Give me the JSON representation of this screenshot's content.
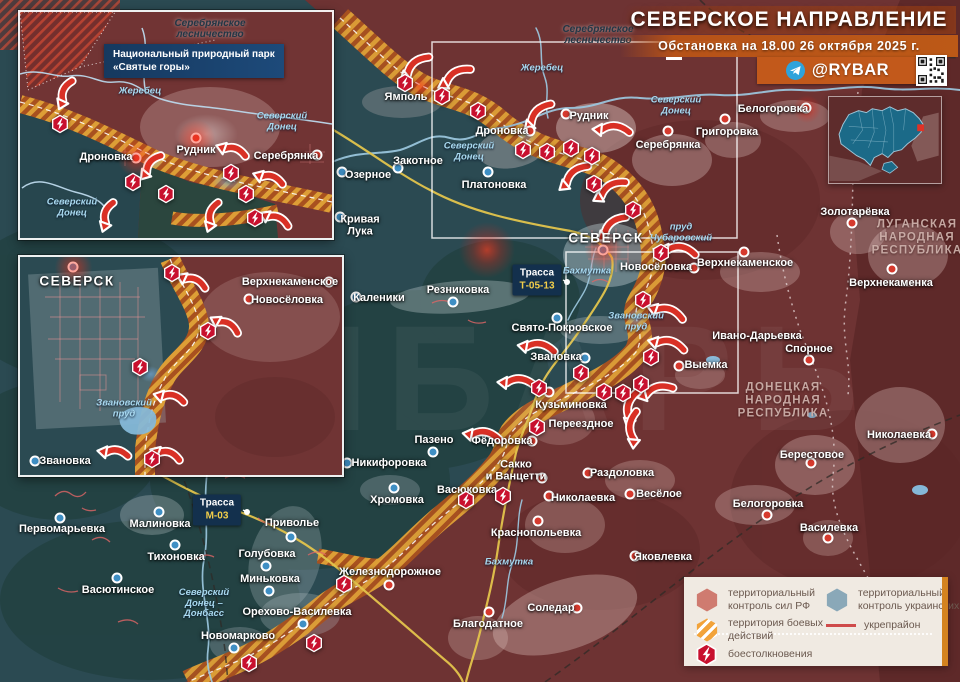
{
  "title": {
    "heading": "СЕВЕРСКОЕ НАПРАВЛЕНИЕ",
    "subtitle": "Обстановка на 18.00 26 октября 2025 г."
  },
  "branding": {
    "telegram_handle": "@RYBAR"
  },
  "colors": {
    "rf_territory": "#6e3333",
    "ua_territory": "#2b4a52",
    "combat_zone": "#dd9e36",
    "combat_stripe": "#a8511f",
    "arrow_red": "#d93025",
    "clash_red": "#c8102e",
    "accent_orange": "#c2591b",
    "legend_bg": "#f0eae2"
  },
  "legend": {
    "items": [
      {
        "id": "rf",
        "label": "территориальный контроль сил РФ"
      },
      {
        "id": "combat",
        "label": "территория боевых действий"
      },
      {
        "id": "clash",
        "label": "боестолкновения"
      },
      {
        "id": "ua",
        "label": "территориальный контроль украинских сил"
      },
      {
        "id": "fort",
        "label": "укрепрайон"
      }
    ]
  },
  "map": {
    "settlements": [
      {
        "n": "Ямполь",
        "x": 406,
        "y": 97,
        "s": "ru"
      },
      {
        "n": "Дроновка",
        "x": 502,
        "y": 131,
        "s": "ru",
        "dot": [
          530,
          131
        ]
      },
      {
        "n": "Рудник",
        "x": 589,
        "y": 116,
        "s": "ru",
        "dot": [
          566,
          114
        ]
      },
      {
        "n": "Серебрянка",
        "x": 668,
        "y": 145,
        "s": "ru",
        "dot": [
          668,
          131
        ]
      },
      {
        "n": "Григоровка",
        "x": 727,
        "y": 132,
        "s": "ru",
        "dot": [
          725,
          119
        ]
      },
      {
        "n": "Белогоровка",
        "x": 773,
        "y": 109,
        "s": "ru",
        "dot": [
          806,
          108
        ]
      },
      {
        "n": "Золотарёвка",
        "x": 855,
        "y": 212,
        "s": "ru",
        "dot": [
          852,
          223
        ]
      },
      {
        "n": "Верхнекаменка",
        "x": 891,
        "y": 283,
        "s": "ru",
        "dot": [
          892,
          269
        ]
      },
      {
        "n": "Озерное",
        "x": 368,
        "y": 175,
        "s": "ua",
        "dot": [
          342,
          172
        ]
      },
      {
        "n": "Закотное",
        "x": 418,
        "y": 161,
        "s": "ua",
        "dot": [
          398,
          168
        ]
      },
      {
        "n": "Платоновка",
        "x": 494,
        "y": 185,
        "s": "ua",
        "dot": [
          488,
          172
        ]
      },
      {
        "n": "Кривая\nЛука",
        "x": 360,
        "y": 226,
        "s": "ua",
        "dot": [
          340,
          217
        ]
      },
      {
        "n": "СЕВЕРСК",
        "x": 606,
        "y": 238,
        "s": "ua",
        "big": true,
        "dot": [
          603,
          250
        ],
        "glow": true
      },
      {
        "n": "Новосёловка",
        "x": 656,
        "y": 267,
        "s": "ru",
        "dot": [
          694,
          268
        ]
      },
      {
        "n": "Верхнекаменское",
        "x": 745,
        "y": 263,
        "s": "ru",
        "dot": [
          744,
          252
        ]
      },
      {
        "n": "Каленики",
        "x": 379,
        "y": 298,
        "s": "ua",
        "dot": [
          356,
          297
        ]
      },
      {
        "n": "Резниковка",
        "x": 458,
        "y": 290,
        "s": "ua",
        "dot": [
          453,
          302
        ]
      },
      {
        "n": "Свято-Покровское",
        "x": 562,
        "y": 328,
        "s": "ua",
        "dot": [
          557,
          318
        ]
      },
      {
        "n": "Звановка",
        "x": 556,
        "y": 357,
        "s": "ua",
        "dot": [
          585,
          358
        ]
      },
      {
        "n": "Ивано-Дарьевка",
        "x": 757,
        "y": 336,
        "s": "ru"
      },
      {
        "n": "Спорное",
        "x": 809,
        "y": 349,
        "s": "ru",
        "dot": [
          809,
          360
        ]
      },
      {
        "n": "Выемка",
        "x": 706,
        "y": 365,
        "s": "ru",
        "dot": [
          679,
          366
        ]
      },
      {
        "n": "Кузьминовка",
        "x": 571,
        "y": 405,
        "s": "ru",
        "dot": [
          549,
          392
        ]
      },
      {
        "n": "Переездное",
        "x": 581,
        "y": 424,
        "s": "ru"
      },
      {
        "n": "Пазено",
        "x": 434,
        "y": 440,
        "s": "ua",
        "dot": [
          433,
          452
        ]
      },
      {
        "n": "Фёдоровка",
        "x": 502,
        "y": 441,
        "s": "ru",
        "dot": [
          532,
          441
        ]
      },
      {
        "n": "Никифоровка",
        "x": 389,
        "y": 463,
        "s": "ua",
        "dot": [
          347,
          463
        ]
      },
      {
        "n": "Хромовка",
        "x": 397,
        "y": 500,
        "s": "ua",
        "dot": [
          394,
          488
        ]
      },
      {
        "n": "Васюковка",
        "x": 467,
        "y": 490,
        "s": "ua"
      },
      {
        "n": "Сакко\nи Ванцетти",
        "x": 516,
        "y": 471,
        "s": "ru",
        "dot": [
          542,
          478
        ]
      },
      {
        "n": "Раздоловка",
        "x": 622,
        "y": 473,
        "s": "ru",
        "dot": [
          588,
          473
        ]
      },
      {
        "n": "Николаевка",
        "x": 583,
        "y": 498,
        "s": "ru",
        "dot": [
          549,
          496
        ]
      },
      {
        "n": "Весёлое",
        "x": 659,
        "y": 494,
        "s": "ru",
        "dot": [
          630,
          494
        ]
      },
      {
        "n": "Краснопольевка",
        "x": 536,
        "y": 533,
        "s": "ru",
        "dot": [
          538,
          521
        ]
      },
      {
        "n": "Яковлевка",
        "x": 663,
        "y": 557,
        "s": "ru",
        "dot": [
          635,
          556
        ]
      },
      {
        "n": "Железнодорожное",
        "x": 390,
        "y": 572,
        "s": "ru",
        "dot": [
          389,
          585
        ]
      },
      {
        "n": "Соледар",
        "x": 551,
        "y": 608,
        "s": "ru",
        "dot": [
          577,
          608
        ]
      },
      {
        "n": "Благодатное",
        "x": 488,
        "y": 624,
        "s": "ru",
        "dot": [
          489,
          612
        ]
      },
      {
        "n": "Малиновка",
        "x": 160,
        "y": 524,
        "s": "ua",
        "dot": [
          159,
          512
        ]
      },
      {
        "n": "Первомарьевка",
        "x": 62,
        "y": 529,
        "s": "ua",
        "dot": [
          60,
          518
        ]
      },
      {
        "n": "Тихоновка",
        "x": 176,
        "y": 557,
        "s": "ua",
        "dot": [
          175,
          545
        ]
      },
      {
        "n": "Васютинское",
        "x": 118,
        "y": 590,
        "s": "ua",
        "dot": [
          117,
          578
        ]
      },
      {
        "n": "Голубовка",
        "x": 267,
        "y": 554,
        "s": "ua",
        "dot": [
          266,
          566
        ]
      },
      {
        "n": "Приволье",
        "x": 292,
        "y": 523,
        "s": "ua",
        "dot": [
          291,
          537
        ]
      },
      {
        "n": "Миньковка",
        "x": 270,
        "y": 579,
        "s": "ua",
        "dot": [
          269,
          591
        ]
      },
      {
        "n": "Орехово-Василевка",
        "x": 297,
        "y": 612,
        "s": "ua",
        "dot": [
          303,
          624
        ]
      },
      {
        "n": "Новомарково",
        "x": 238,
        "y": 636,
        "s": "ua",
        "dot": [
          234,
          648
        ]
      },
      {
        "n": "Николаевка",
        "x": 899,
        "y": 435,
        "s": "ru",
        "dot": [
          932,
          434
        ]
      },
      {
        "n": "Берестовое",
        "x": 812,
        "y": 455,
        "s": "ru",
        "dot": [
          811,
          463
        ]
      },
      {
        "n": "Белогоровка",
        "x": 768,
        "y": 504,
        "s": "ru",
        "dot": [
          767,
          515
        ]
      },
      {
        "n": "Василевка",
        "x": 829,
        "y": 528,
        "s": "ru",
        "dot": [
          828,
          538
        ]
      }
    ],
    "water": [
      {
        "t": "Жеребец",
        "x": 542,
        "y": 69
      },
      {
        "t": "Северский\nДонец",
        "x": 469,
        "y": 152
      },
      {
        "t": "Северский\nДонец",
        "x": 676,
        "y": 106
      },
      {
        "t": "Бахмутка",
        "x": 587,
        "y": 272
      },
      {
        "t": "Бахмутка",
        "x": 509,
        "y": 563
      },
      {
        "t": "пруд\nЧубаровский",
        "x": 681,
        "y": 233
      },
      {
        "t": "Звановский\nпруд",
        "x": 636,
        "y": 322
      },
      {
        "t": "Северский\nДонец –\nДонбасс",
        "x": 204,
        "y": 604
      }
    ],
    "regions": [
      {
        "t": "ЛУГАНСКАЯ\nНАРОДНАЯ\nРЕСПУБЛИКА",
        "x": 917,
        "y": 238
      },
      {
        "t": "ДОНЕЦКАЯ\nНАРОДНАЯ\nРЕСПУБЛИКА",
        "x": 783,
        "y": 401
      }
    ],
    "forests": [
      {
        "t": "Серебрянское\nлесничество",
        "x": 598,
        "y": 35
      }
    ],
    "roads": [
      {
        "name": "Трасса",
        "num": "Т-05-13",
        "x": 537,
        "y": 280,
        "dot": [
          567,
          282
        ]
      },
      {
        "name": "Трасса",
        "num": "М-03",
        "x": 217,
        "y": 510,
        "dot": [
          247,
          512
        ]
      }
    ],
    "clashes": [
      [
        405,
        83
      ],
      [
        442,
        96
      ],
      [
        478,
        111
      ],
      [
        523,
        150
      ],
      [
        547,
        152
      ],
      [
        571,
        148
      ],
      [
        592,
        156
      ],
      [
        594,
        184
      ],
      [
        633,
        210
      ],
      [
        661,
        253
      ],
      [
        643,
        300
      ],
      [
        651,
        357
      ],
      [
        641,
        384
      ],
      [
        623,
        393
      ],
      [
        604,
        392
      ],
      [
        581,
        373
      ],
      [
        539,
        388
      ],
      [
        537,
        427
      ],
      [
        503,
        496
      ],
      [
        466,
        500
      ],
      [
        344,
        584
      ],
      [
        249,
        663
      ],
      [
        314,
        643
      ]
    ],
    "arrows": [
      [
        417,
        67,
        140
      ],
      [
        457,
        77,
        150
      ],
      [
        540,
        115,
        135
      ],
      [
        614,
        131,
        185
      ],
      [
        576,
        176,
        140
      ],
      [
        612,
        190,
        150
      ],
      [
        614,
        227,
        140
      ],
      [
        680,
        252,
        190
      ],
      [
        668,
        314,
        200
      ],
      [
        669,
        346,
        195
      ],
      [
        658,
        392,
        165
      ],
      [
        633,
        407,
        105
      ],
      [
        635,
        427,
        95
      ],
      [
        539,
        349,
        190
      ],
      [
        519,
        384,
        185
      ],
      [
        484,
        437,
        190
      ]
    ],
    "glows_red": [
      [
        487,
        250,
        28
      ],
      [
        807,
        109,
        14
      ],
      [
        420,
        86,
        11
      ]
    ],
    "glows_blue": [
      [
        527,
        133,
        11
      ],
      [
        636,
        318,
        10
      ]
    ]
  },
  "insets": {
    "north": {
      "forest": "Серебрянское\nлесничество",
      "park": "Национальный природный парк\n«Святые горы»",
      "settlements": [
        {
          "n": "Дроновка",
          "x": 86,
          "y": 145,
          "s": "ru",
          "dot": [
            116,
            146
          ],
          "glow": true
        },
        {
          "n": "Рудник",
          "x": 176,
          "y": 138,
          "s": "ru",
          "dot": [
            176,
            126
          ],
          "glow": true
        },
        {
          "n": "Серебрянка",
          "x": 266,
          "y": 144,
          "s": "ru",
          "dot": [
            297,
            143
          ]
        }
      ],
      "water": [
        {
          "t": "Жеребец",
          "x": 120,
          "y": 80
        },
        {
          "t": "Северский\nДонец",
          "x": 262,
          "y": 110
        },
        {
          "t": "Северский\nДонец",
          "x": 52,
          "y": 196
        }
      ],
      "clashes": [
        [
          40,
          112
        ],
        [
          113,
          170
        ],
        [
          146,
          182
        ],
        [
          211,
          161
        ],
        [
          226,
          182
        ],
        [
          235,
          206
        ]
      ],
      "arrows": [
        [
          47,
          80,
          115
        ],
        [
          133,
          153,
          130
        ],
        [
          214,
          140,
          200
        ],
        [
          251,
          168,
          200
        ],
        [
          89,
          202,
          110
        ],
        [
          194,
          202,
          110
        ],
        [
          257,
          209,
          205
        ]
      ]
    },
    "seversk": {
      "settlements": [
        {
          "n": "СЕВЕРСК",
          "x": 57,
          "y": 24,
          "s": "ua",
          "big": true,
          "dot": [
            53,
            10
          ],
          "glow": true
        },
        {
          "n": "Верхнекаменское",
          "x": 270,
          "y": 25,
          "s": "ru",
          "dot": [
            309,
            25
          ]
        },
        {
          "n": "Новосёловка",
          "x": 267,
          "y": 43,
          "s": "ru",
          "dot": [
            229,
            42
          ]
        },
        {
          "n": "Звановка",
          "x": 45,
          "y": 204,
          "s": "ua",
          "dot": [
            15,
            204
          ]
        }
      ],
      "water": [
        {
          "t": "Звановский\nпруд",
          "x": 104,
          "y": 152
        }
      ],
      "clashes": [
        [
          152,
          16
        ],
        [
          188,
          74
        ],
        [
          120,
          110
        ],
        [
          132,
          202
        ]
      ],
      "arrows": [
        [
          174,
          26,
          205
        ],
        [
          207,
          70,
          210
        ],
        [
          152,
          142,
          195
        ],
        [
          148,
          199,
          200
        ],
        [
          96,
          197,
          190
        ]
      ]
    }
  }
}
